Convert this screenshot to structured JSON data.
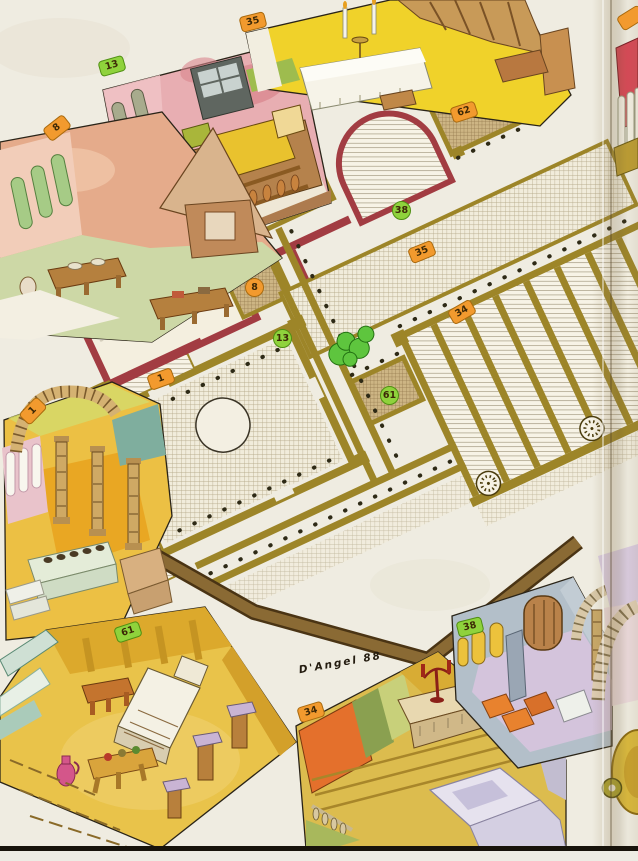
{
  "figure": {
    "type": "isometric palace floor plan with cutaway room vignettes",
    "signature": "D'Angel 88"
  },
  "plan": {
    "numbered_locations": [
      "1",
      "8",
      "13",
      "34",
      "35",
      "38",
      "61",
      "62"
    ],
    "landmarks": [
      "central-pool",
      "courtyard-trees",
      "spiral-staircase",
      "spiral-staircase",
      "perimeter-wall"
    ]
  },
  "badges": [
    {
      "label": "13",
      "color": "green",
      "shape": "pill",
      "area": "vignette-top-left"
    },
    {
      "label": "35",
      "color": "orange",
      "shape": "pill",
      "area": "vignette-top"
    },
    {
      "label": "8",
      "color": "orange",
      "shape": "pill",
      "area": "vignette-left"
    },
    {
      "label": "1",
      "color": "orange",
      "shape": "pill",
      "area": "vignette-atrium"
    },
    {
      "label": "61",
      "color": "green",
      "shape": "pill",
      "area": "vignette-bottom-left"
    },
    {
      "label": "34",
      "color": "orange",
      "shape": "pill",
      "area": "vignette-bottom-center"
    },
    {
      "label": "38",
      "color": "green",
      "shape": "pill",
      "area": "vignette-bottom-right"
    },
    {
      "label": "62",
      "color": "orange",
      "shape": "pill",
      "area": "plan"
    },
    {
      "label": "38",
      "color": "green",
      "shape": "circle",
      "area": "plan"
    },
    {
      "label": "35",
      "color": "orange",
      "shape": "pill",
      "area": "plan"
    },
    {
      "label": "8",
      "color": "orange",
      "shape": "circle",
      "area": "plan"
    },
    {
      "label": "13",
      "color": "green",
      "shape": "circle",
      "area": "plan"
    },
    {
      "label": "34",
      "color": "orange",
      "shape": "pill",
      "area": "plan"
    },
    {
      "label": "1",
      "color": "orange",
      "shape": "pill",
      "area": "plan"
    },
    {
      "label": "61",
      "color": "green",
      "shape": "circle",
      "area": "plan"
    },
    {
      "label": "",
      "color": "orange",
      "shape": "pill",
      "area": "page-fold-partial"
    }
  ],
  "vignettes": [
    {
      "badge": "13",
      "scene": "pink bedchamber with bed and balustraded balcony"
    },
    {
      "badge": "35",
      "scene": "refectory with cloth-covered altar table and candles"
    },
    {
      "badge": "8",
      "scene": "kitchen with pyramidal hearth and wooden tables"
    },
    {
      "badge": "1",
      "scene": "arched atrium with fluted columns"
    },
    {
      "badge": "61",
      "scene": "bedroom with bed, tables, stools and jug"
    },
    {
      "badge": "34",
      "scene": "chapel altar with candelabrum"
    },
    {
      "badge": "38",
      "scene": "hall with arched windows, door and benches"
    }
  ],
  "palette": {
    "paper": "#efece1",
    "plan_wall_gold": "#9d8528",
    "plan_wall_maroon": "#a23c42",
    "perimeter_brown": "#7a5a28",
    "badge_green": "#8fd23c",
    "badge_orange": "#f29a2e"
  }
}
